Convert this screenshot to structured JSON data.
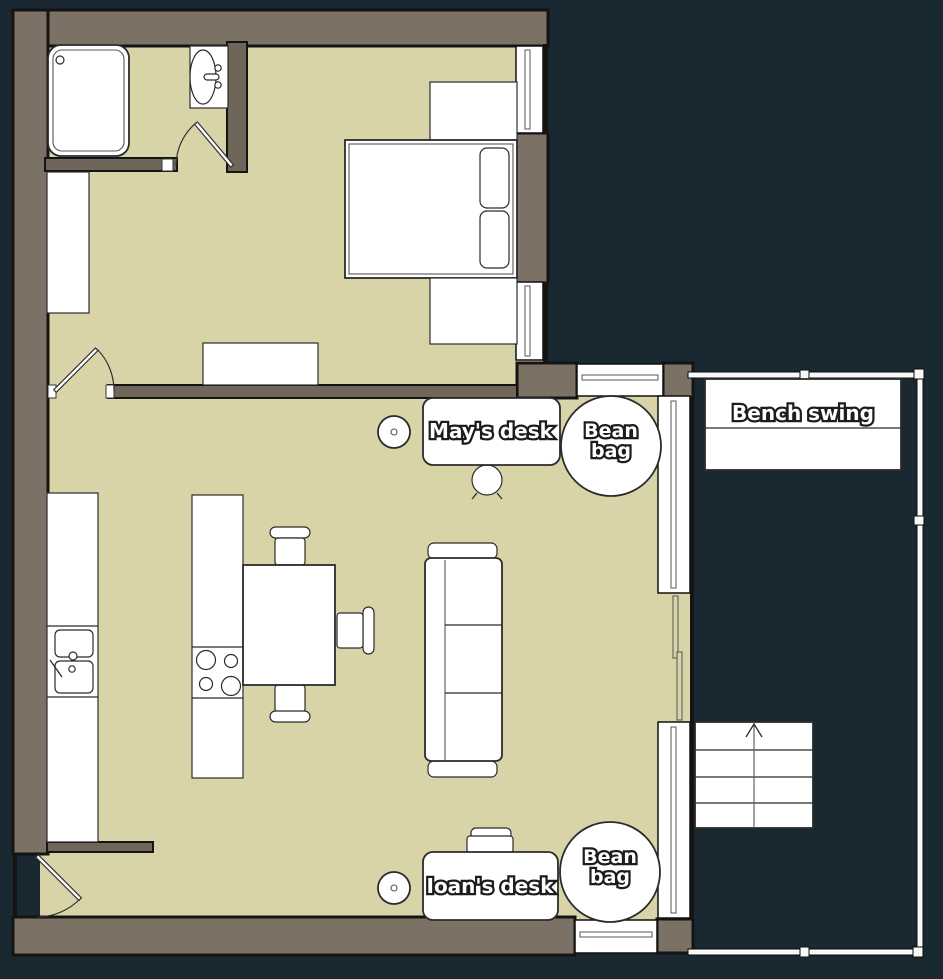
{
  "labels": {
    "mays_desk": "May's desk",
    "ioans_desk": "Ioan's desk",
    "bench_swing": "Bench swing",
    "bean_bag": {
      "line1": "Bean",
      "line2": "bag"
    }
  },
  "palette": {
    "outside": "#1a2931",
    "wall": "#7b7164",
    "wall_interior": "#6f6659",
    "floor": "#d9d3a8",
    "furniture": "#ffffff",
    "outline": "#141414",
    "label_fill": "#ffffff",
    "label_stroke": "#1c1c1c"
  },
  "plan": {
    "rooms": [
      {
        "id": "bathroom",
        "furniture": [
          "shower",
          "sink",
          "door"
        ]
      },
      {
        "id": "bedroom",
        "furniture": [
          "double-bed",
          "pillows",
          "nightstand-north",
          "nightstand-south",
          "wardrobe",
          "dresser",
          "door"
        ]
      },
      {
        "id": "living-kitchen",
        "furniture": [
          "kitchen-counter",
          "double-sink",
          "island-cooktop",
          "dining-table",
          "three-chairs",
          "sofa",
          "mays-desk",
          "desk-stool",
          "ioans-desk",
          "office-chair",
          "bean-bag-north",
          "bean-bag-south",
          "entrance-door",
          "sliding-door"
        ]
      },
      {
        "id": "balcony",
        "furniture": [
          "bench-swing",
          "stairs-up",
          "railing"
        ]
      }
    ]
  }
}
